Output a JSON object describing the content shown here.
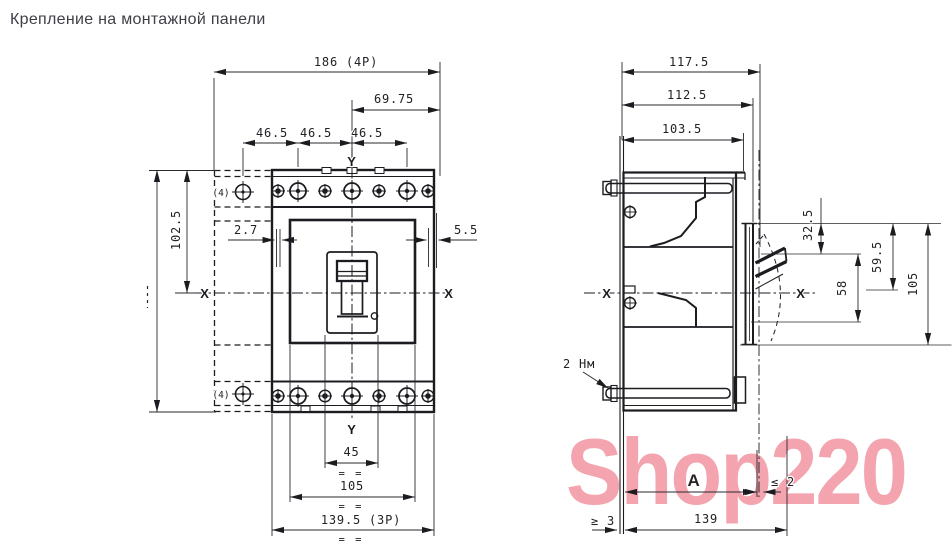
{
  "title": "Крепление на монтажной панели",
  "watermark": "Shop220",
  "front_view": {
    "dim_width_4p": "186 (4P)",
    "dim_offset_right": "69.75",
    "dim_pitch_a": "46.5",
    "dim_pitch_b": "46.5",
    "dim_pitch_c": "46.5",
    "dim_height_upper": "102.5",
    "dim_gap_left": "2.7",
    "dim_gap_right": "5.5",
    "dim_slot": "45",
    "dim_face": "105",
    "dim_width_3p": "139.5 (3P)",
    "axis_x_left": "X",
    "axis_x_right": "X",
    "axis_y_top": "Y",
    "axis_y_bottom": "Y",
    "pole4_label_top": "(4)",
    "pole4_label_bottom": "(4)",
    "eq_mark_1": "= =",
    "eq_mark_2": "= =",
    "eq_mark_3": "= ="
  },
  "side_view": {
    "dim_depth_overall": "117.5",
    "dim_depth_cover": "112.5",
    "dim_depth_body": "103.5",
    "dim_handle_top": "32.5",
    "dim_axis_top": "59.5",
    "dim_handle_span": "58",
    "dim_front_height": "105",
    "dim_door_distance": "A",
    "dim_door_gap": "≤ 2",
    "dim_panel_thickness": "≥ 3",
    "dim_depth_to_handle": "139",
    "torque_label": "2 Нм",
    "axis_x_left": "X",
    "axis_x_right": "X"
  }
}
